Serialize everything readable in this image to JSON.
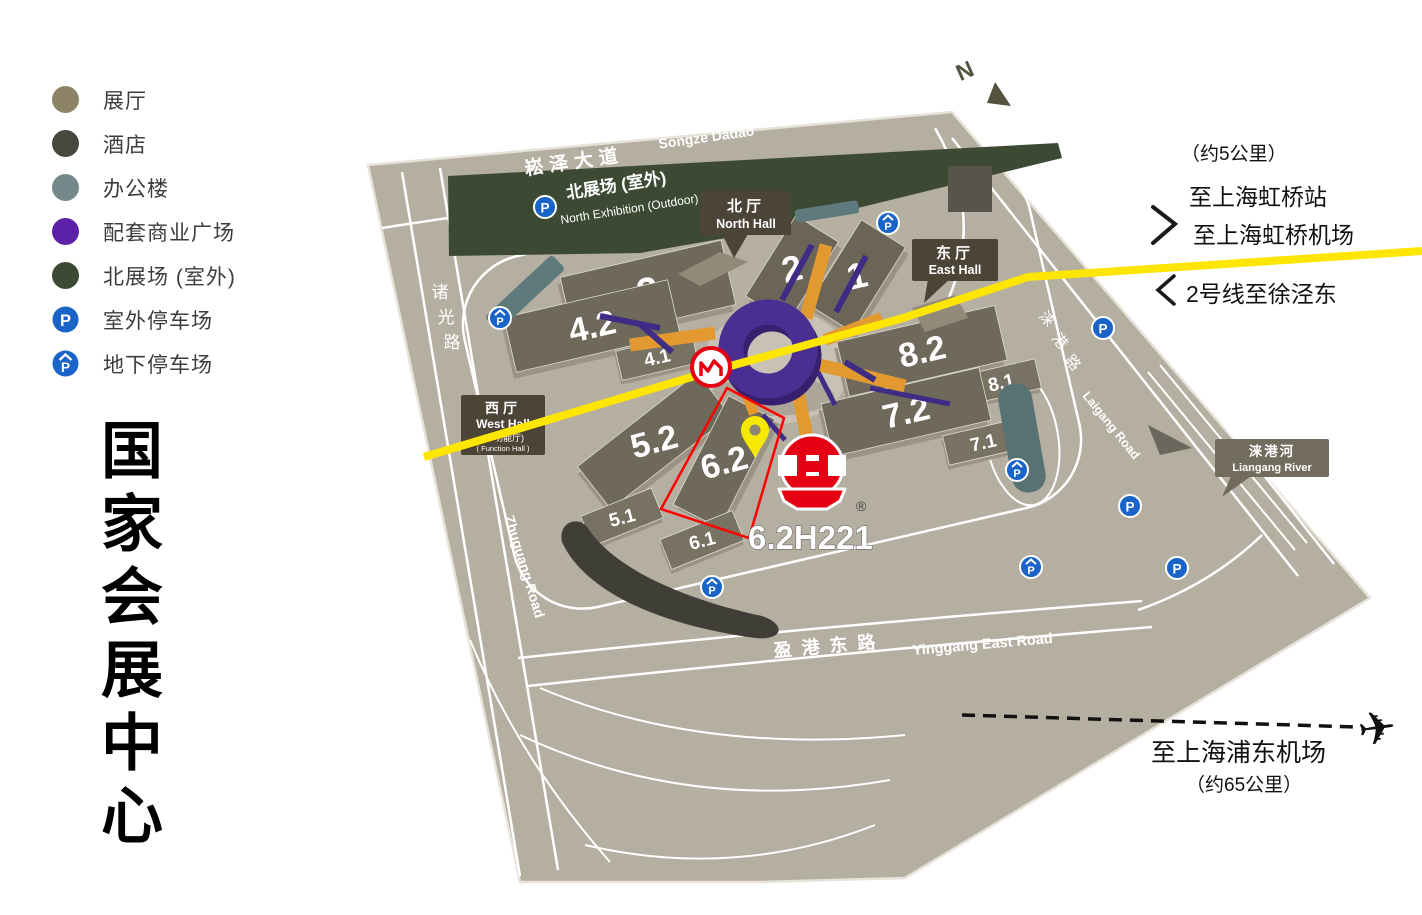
{
  "title": {
    "text": "国家会展中心"
  },
  "legend": {
    "items": [
      {
        "label": "展厅",
        "color": "#8d8466"
      },
      {
        "label": "酒店",
        "color": "#474740"
      },
      {
        "label": "办公楼",
        "color": "#75898a"
      },
      {
        "label": "配套商业广场",
        "color": "#5d21a8"
      },
      {
        "label": "北展场 (室外)",
        "color": "#3c4a34"
      },
      {
        "label": "室外停车场",
        "color": "#1a63c8"
      },
      {
        "label": "地下停车场",
        "color": "#1a63c8"
      }
    ]
  },
  "icons": {
    "parking": "P",
    "airplane": "✈",
    "registered": "®",
    "compass_north": "N"
  },
  "map": {
    "halls": [
      {
        "label": "3"
      },
      {
        "label": "2"
      },
      {
        "label": "1"
      },
      {
        "label": "4.2"
      },
      {
        "label": "4.1"
      },
      {
        "label": "8.2"
      },
      {
        "label": "8.1"
      },
      {
        "label": "7.2"
      },
      {
        "label": "7.1"
      },
      {
        "label": "5.2"
      },
      {
        "label": "5.1"
      },
      {
        "label": "6.2"
      },
      {
        "label": "6.1"
      }
    ],
    "gates": {
      "north": {
        "zh": "北厅",
        "en": "North Hall"
      },
      "east": {
        "zh": "东厅",
        "en": "East Hall"
      },
      "west": {
        "zh": "西厅",
        "en": "West Hall",
        "sub_zh": "(多功能厅)",
        "sub_en": "( Function Hall )"
      }
    },
    "roads": {
      "songze_zh": "崧泽大道",
      "songze_en": "Songze Dadao",
      "zhuguang_zh": [
        "诸",
        "光",
        "路"
      ],
      "zhuguang_en": "Zhuguang Road",
      "yinggang_zh": "盈港东路",
      "yinggang_en": "Yinggang East Road",
      "laigang_zh": [
        "涞",
        "港",
        "路"
      ],
      "laigang_en": "Laigang Road"
    },
    "river": {
      "zh": "涞港河",
      "en": "Liangang River"
    },
    "north_exhibition": {
      "zh": "北展场 (室外)",
      "en": "North Exhibition (Outdoor)"
    },
    "booth": "6.2H221"
  },
  "annotations": {
    "metro_distance": "（约5公里）",
    "to_hongqiao_station": "至上海虹桥站",
    "to_hongqiao_airport": "至上海虹桥机场",
    "metro_line2": "2号线至徐泾东",
    "to_pudong_airport": "至上海浦东机场",
    "pudong_distance": "（约65公里）"
  }
}
